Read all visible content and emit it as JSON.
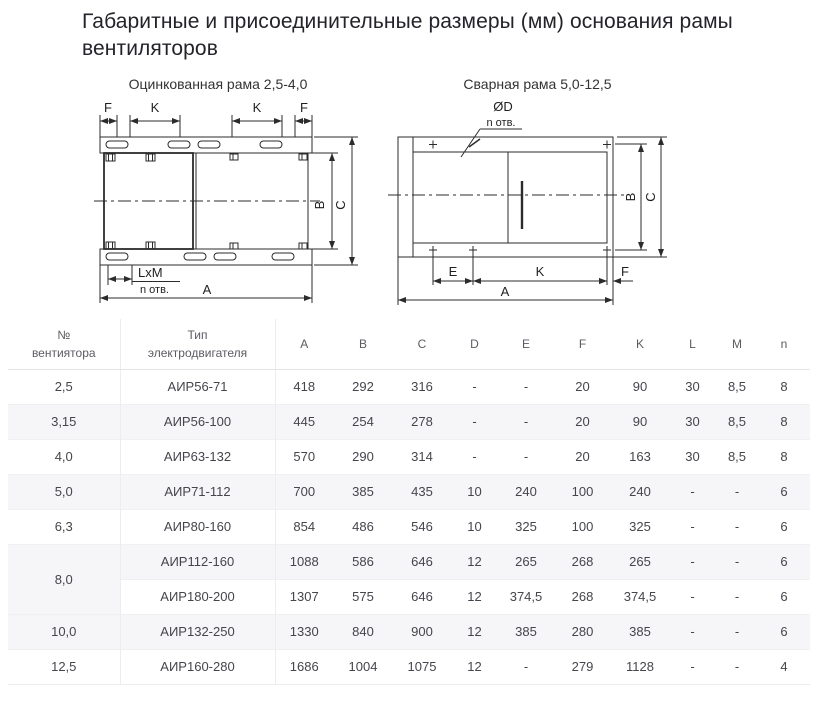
{
  "page_title": "Габаритные и присоединительные размеры (мм) основания рамы вентиляторов",
  "diagrams": {
    "galvanized": {
      "title": "Оцинкованная рама 2,5-4,0",
      "dim_f": "F",
      "dim_k": "K",
      "dim_b": "B",
      "dim_c": "C",
      "dim_a": "A",
      "dim_lxm": "LxM",
      "holes": "n отв."
    },
    "welded": {
      "title": "Сварная рама 5,0-12,5",
      "hole_dia": "ØD",
      "holes": "n отв.",
      "dim_e": "E",
      "dim_k": "K",
      "dim_f": "F",
      "dim_a": "A",
      "dim_b": "B",
      "dim_c": "C"
    }
  },
  "table": {
    "col_fan_no": {
      "line1": "№",
      "line2": "вентиятора"
    },
    "col_motor": {
      "line1": "Тип",
      "line2": "электродвигателя"
    },
    "dim_headers": [
      "A",
      "B",
      "C",
      "D",
      "E",
      "F",
      "K",
      "L",
      "M",
      "n"
    ],
    "rows": [
      {
        "fan": "2,5",
        "motor": "АИР56-71",
        "A": "418",
        "B": "292",
        "C": "316",
        "D": "-",
        "E": "-",
        "F": "20",
        "K": "90",
        "L": "30",
        "M": "8,5",
        "n": "8"
      },
      {
        "fan": "3,15",
        "motor": "АИР56-100",
        "A": "445",
        "B": "254",
        "C": "278",
        "D": "-",
        "E": "-",
        "F": "20",
        "K": "90",
        "L": "30",
        "M": "8,5",
        "n": "8"
      },
      {
        "fan": "4,0",
        "motor": "АИР63-132",
        "A": "570",
        "B": "290",
        "C": "314",
        "D": "-",
        "E": "-",
        "F": "20",
        "K": "163",
        "L": "30",
        "M": "8,5",
        "n": "8"
      },
      {
        "fan": "5,0",
        "motor": "АИР71-112",
        "A": "700",
        "B": "385",
        "C": "435",
        "D": "10",
        "E": "240",
        "F": "100",
        "K": "240",
        "L": "-",
        "M": "-",
        "n": "6"
      },
      {
        "fan": "6,3",
        "motor": "АИР80-160",
        "A": "854",
        "B": "486",
        "C": "546",
        "D": "10",
        "E": "325",
        "F": "100",
        "K": "325",
        "L": "-",
        "M": "-",
        "n": "6"
      },
      {
        "fan": "8,0",
        "motor": "АИР112-160",
        "A": "1088",
        "B": "586",
        "C": "646",
        "D": "12",
        "E": "265",
        "F": "268",
        "K": "265",
        "L": "-",
        "M": "-",
        "n": "6"
      },
      {
        "fan": "",
        "motor": "АИР180-200",
        "A": "1307",
        "B": "575",
        "C": "646",
        "D": "12",
        "E": "374,5",
        "F": "268",
        "K": "374,5",
        "L": "-",
        "M": "-",
        "n": "6"
      },
      {
        "fan": "10,0",
        "motor": "АИР132-250",
        "A": "1330",
        "B": "840",
        "C": "900",
        "D": "12",
        "E": "385",
        "F": "280",
        "K": "385",
        "L": "-",
        "M": "-",
        "n": "6"
      },
      {
        "fan": "12,5",
        "motor": "АИР160-280",
        "A": "1686",
        "B": "1004",
        "C": "1075",
        "D": "12",
        "E": "-",
        "F": "279",
        "K": "1128",
        "L": "-",
        "M": "-",
        "n": "4"
      }
    ]
  }
}
